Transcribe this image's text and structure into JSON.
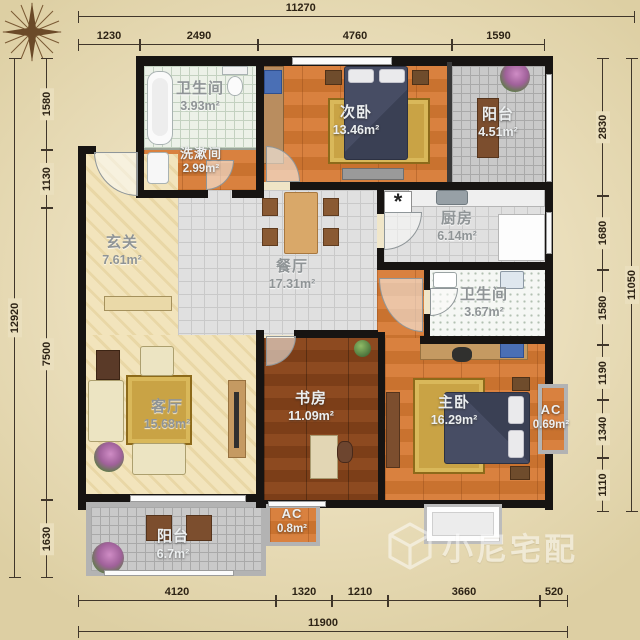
{
  "rooms": {
    "bath1": {
      "name": "卫生间",
      "area": "3.93m²"
    },
    "washroom": {
      "name": "洗漱间",
      "area": "2.99m²"
    },
    "bedroom2": {
      "name": "次卧",
      "area": "13.46m²"
    },
    "balcony1": {
      "name": "阳台",
      "area": "4.51m²"
    },
    "kitchen": {
      "name": "厨房",
      "area": "6.14m²"
    },
    "foyer": {
      "name": "玄关",
      "area": "7.61m²"
    },
    "dining": {
      "name": "餐厅",
      "area": "17.31m²"
    },
    "bath2": {
      "name": "卫生间",
      "area": "3.67m²"
    },
    "living": {
      "name": "客厅",
      "area": "15.68m²"
    },
    "study": {
      "name": "书房",
      "area": "11.09m²"
    },
    "master": {
      "name": "主卧",
      "area": "16.29m²"
    },
    "ac1": {
      "name": "AC",
      "area": "0.69m²"
    },
    "balcony2": {
      "name": "阳台",
      "area": "6.7m²"
    },
    "ac2": {
      "name": "AC",
      "area": "0.8m²"
    }
  },
  "dims": {
    "top_total": "11270",
    "top": [
      "1230",
      "2490",
      "4760",
      "1590"
    ],
    "bottom_total": "11900",
    "bottom": [
      "4120",
      "1320",
      "1210",
      "3660",
      "520"
    ],
    "left_total": "12920",
    "left": [
      "1580",
      "1130",
      "7500",
      "1630"
    ],
    "right_total": "11050",
    "right": [
      "2830",
      "1680",
      "1580",
      "1190",
      "1340",
      "1110"
    ]
  },
  "symbols": {
    "gas": "*"
  },
  "watermark": {
    "text": "小尼宅配"
  }
}
